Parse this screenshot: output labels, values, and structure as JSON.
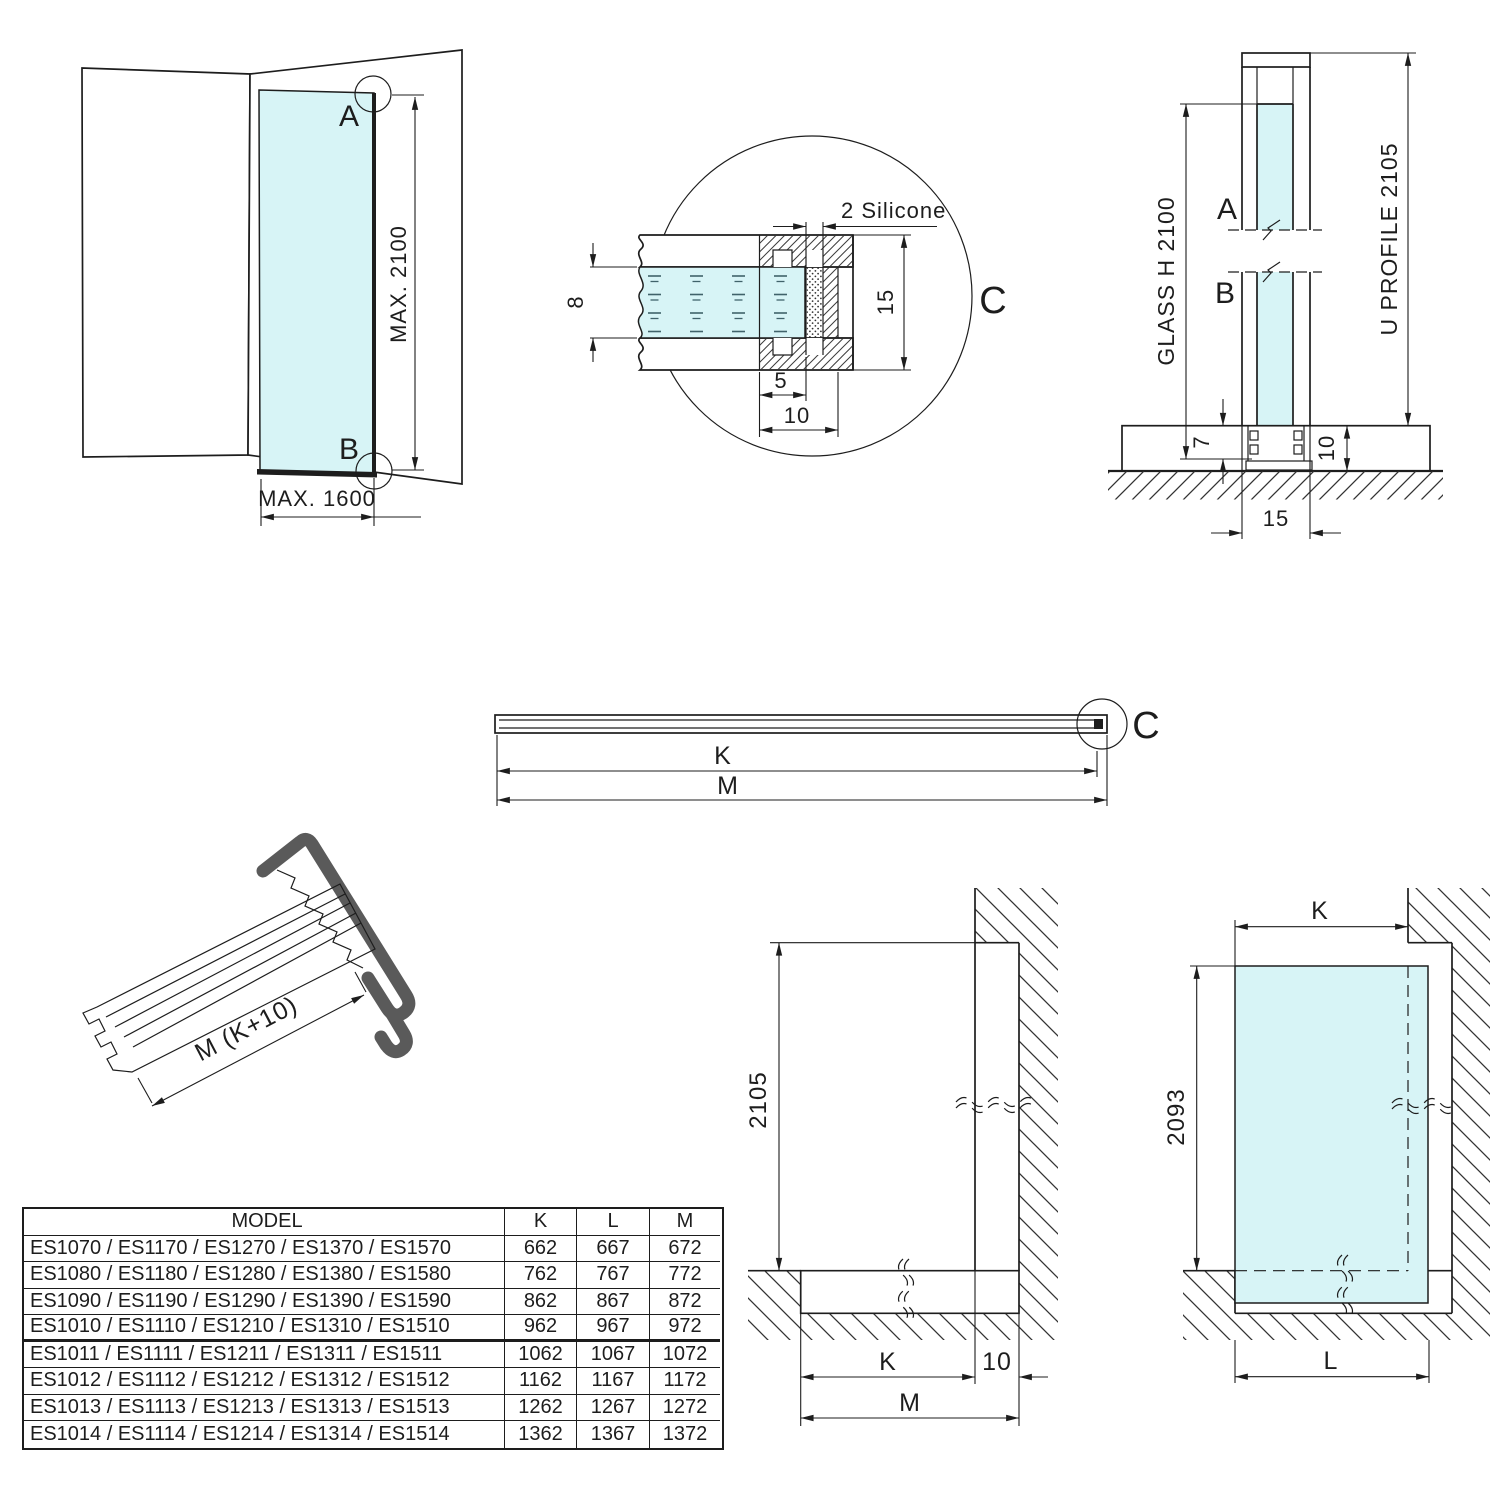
{
  "sheet": {
    "background": "#ffffff",
    "line_color": "#1d1d1d",
    "glass_color": "#d7f4f6",
    "profile_symbol_color": "#5a5a5a"
  },
  "corner_view": {
    "label_a": "A",
    "label_b": "B",
    "dim_height": "MAX. 2100",
    "dim_width": "MAX. 1600"
  },
  "detail_view": {
    "label": "C",
    "silicone_note": "2 Silicone",
    "dim_glass_thickness": "8",
    "dim_profile_height": "15",
    "dim_inner": "5",
    "dim_outer": "10"
  },
  "section_view": {
    "label_a": "A",
    "label_b": "B",
    "dim_glass": "GLASS H 2100",
    "dim_profile": "U PROFILE 2105",
    "dim_inset": "7",
    "dim_base_height": "10",
    "dim_base_width": "15"
  },
  "profile_view": {
    "label": "C",
    "dim_k": "K",
    "dim_m": "M"
  },
  "profile_3d": {
    "dim_length": "M (K+10)"
  },
  "opening_view": {
    "dim_height": "2105",
    "dim_k": "K",
    "dim_gap": "10",
    "dim_m": "M"
  },
  "glass_view": {
    "dim_k": "K",
    "dim_height": "2093",
    "dim_l": "L"
  },
  "size_table": {
    "headers": {
      "model": "MODEL",
      "k": "K",
      "l": "L",
      "m": "M"
    },
    "rows": [
      {
        "model": "ES1070 / ES1170 / ES1270 / ES1370 / ES1570",
        "k": "662",
        "l": "667",
        "m": "672"
      },
      {
        "model": "ES1080 / ES1180 / ES1280 / ES1380 / ES1580",
        "k": "762",
        "l": "767",
        "m": "772"
      },
      {
        "model": "ES1090 / ES1190 / ES1290 / ES1390 / ES1590",
        "k": "862",
        "l": "867",
        "m": "872"
      },
      {
        "model": "ES1010 / ES1110 / ES1210 / ES1310 / ES1510",
        "k": "962",
        "l": "967",
        "m": "972"
      },
      {
        "model": "ES1011 / ES1111 / ES1211 / ES1311 / ES1511",
        "k": "1062",
        "l": "1067",
        "m": "1072"
      },
      {
        "model": "ES1012 / ES1112 / ES1212 / ES1312 / ES1512",
        "k": "1162",
        "l": "1167",
        "m": "1172"
      },
      {
        "model": "ES1013 / ES1113 / ES1213 / ES1313 / ES1513",
        "k": "1262",
        "l": "1267",
        "m": "1272"
      },
      {
        "model": "ES1014 / ES1114 / ES1214 / ES1314 / ES1514",
        "k": "1362",
        "l": "1367",
        "m": "1372"
      }
    ]
  }
}
